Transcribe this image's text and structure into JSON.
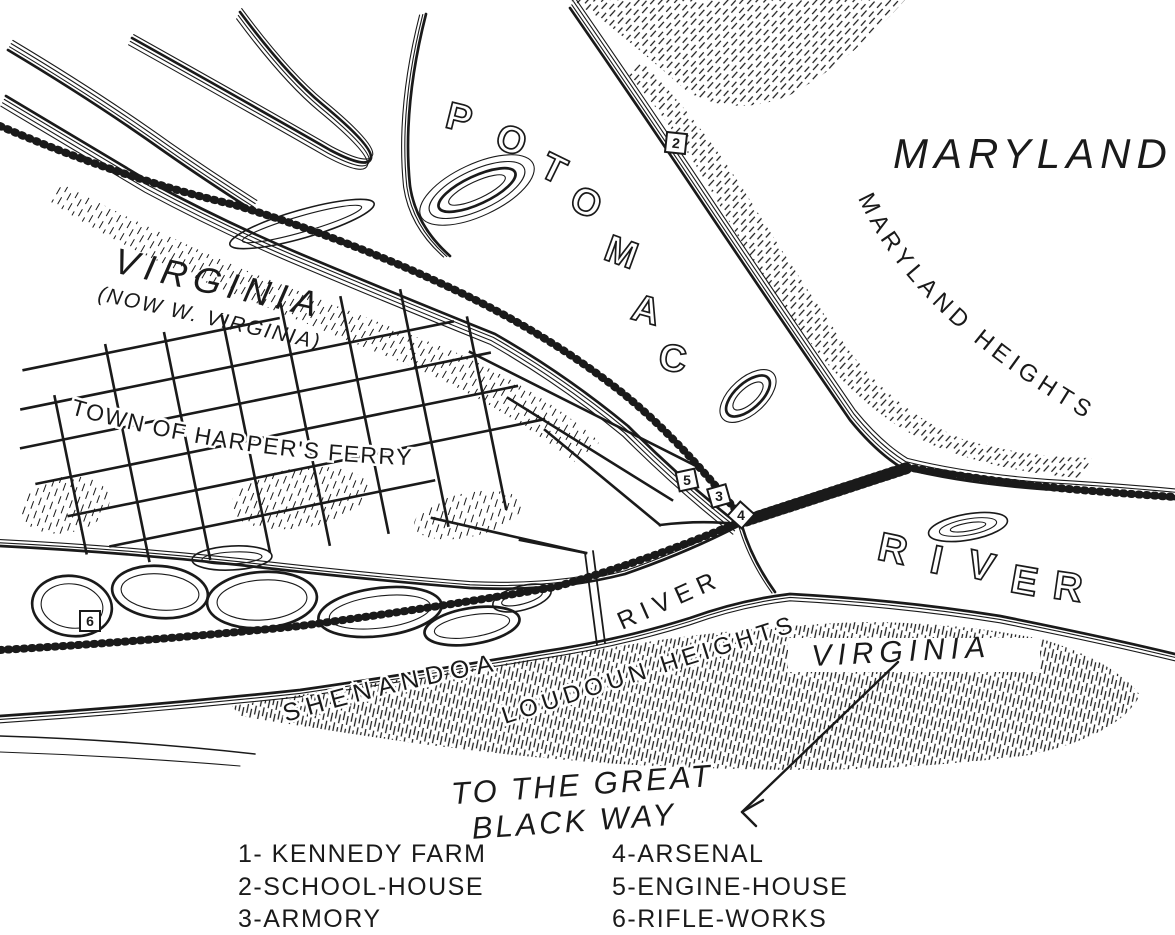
{
  "colors": {
    "ink": "#1a1a1a",
    "paper": "#ffffff"
  },
  "labels": {
    "maryland": "MARYLAND",
    "maryland_heights": "MARYLAND HEIGHTS",
    "virginia_nw": "VIRGINIA",
    "virginia_nw_sub": "(NOW W. VIRGINIA)",
    "town": "TOWN OF HARPER'S FERRY",
    "shenandoah": "SHENANDOAH",
    "shenandoah_river_word": "RIVER",
    "loudoun_heights": "LOUDOUN HEIGHTS",
    "virginia_se": "VIRGINIA",
    "annotation_line1": "TO THE GREAT",
    "annotation_line2": "BLACK WAY"
  },
  "letters": {
    "potomac": [
      "P",
      "O",
      "T",
      "O",
      "M",
      "A",
      "C"
    ],
    "river": [
      "R",
      "I",
      "V",
      "E",
      "R"
    ]
  },
  "markers": {
    "m2": "2",
    "m3": "3",
    "m4": "4",
    "m5": "5",
    "m6": "6"
  },
  "legend": {
    "items": [
      "1- KENNEDY FARM",
      "2-SCHOOL-HOUSE",
      "3-ARMORY",
      "4-ARSENAL",
      "5-ENGINE-HOUSE",
      "6-RIFLE-WORKS"
    ]
  }
}
